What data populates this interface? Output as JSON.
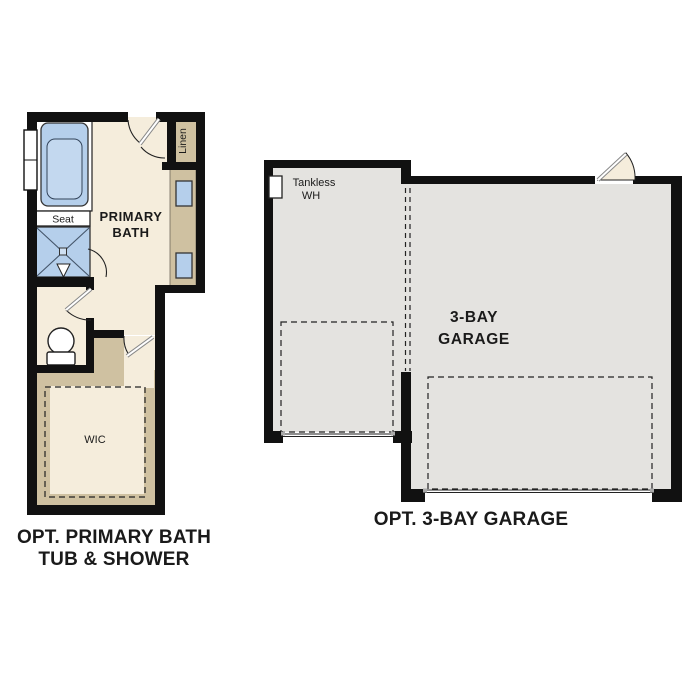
{
  "bath_plan": {
    "room_label_line1": "PRIMARY",
    "room_label_line2": "BATH",
    "seat_label": "Seat",
    "linen_label": "Linen",
    "wic_label": "WIC",
    "caption_line1": "OPT. PRIMARY BATH",
    "caption_line2": "TUB & SHOWER"
  },
  "garage_plan": {
    "water_heater_label_line1": "Tankless",
    "water_heater_label_line2": "WH",
    "room_label_line1": "3-BAY",
    "room_label_line2": "GARAGE",
    "caption": "OPT. 3-BAY GARAGE"
  },
  "colors": {
    "background": "#ffffff",
    "wall": "#111111",
    "bath_floor": "#f5eddc",
    "cabinet_tan": "#cfc1a1",
    "fixture_blue": "#b5cfeb",
    "garage_floor": "#e4e3e0"
  }
}
